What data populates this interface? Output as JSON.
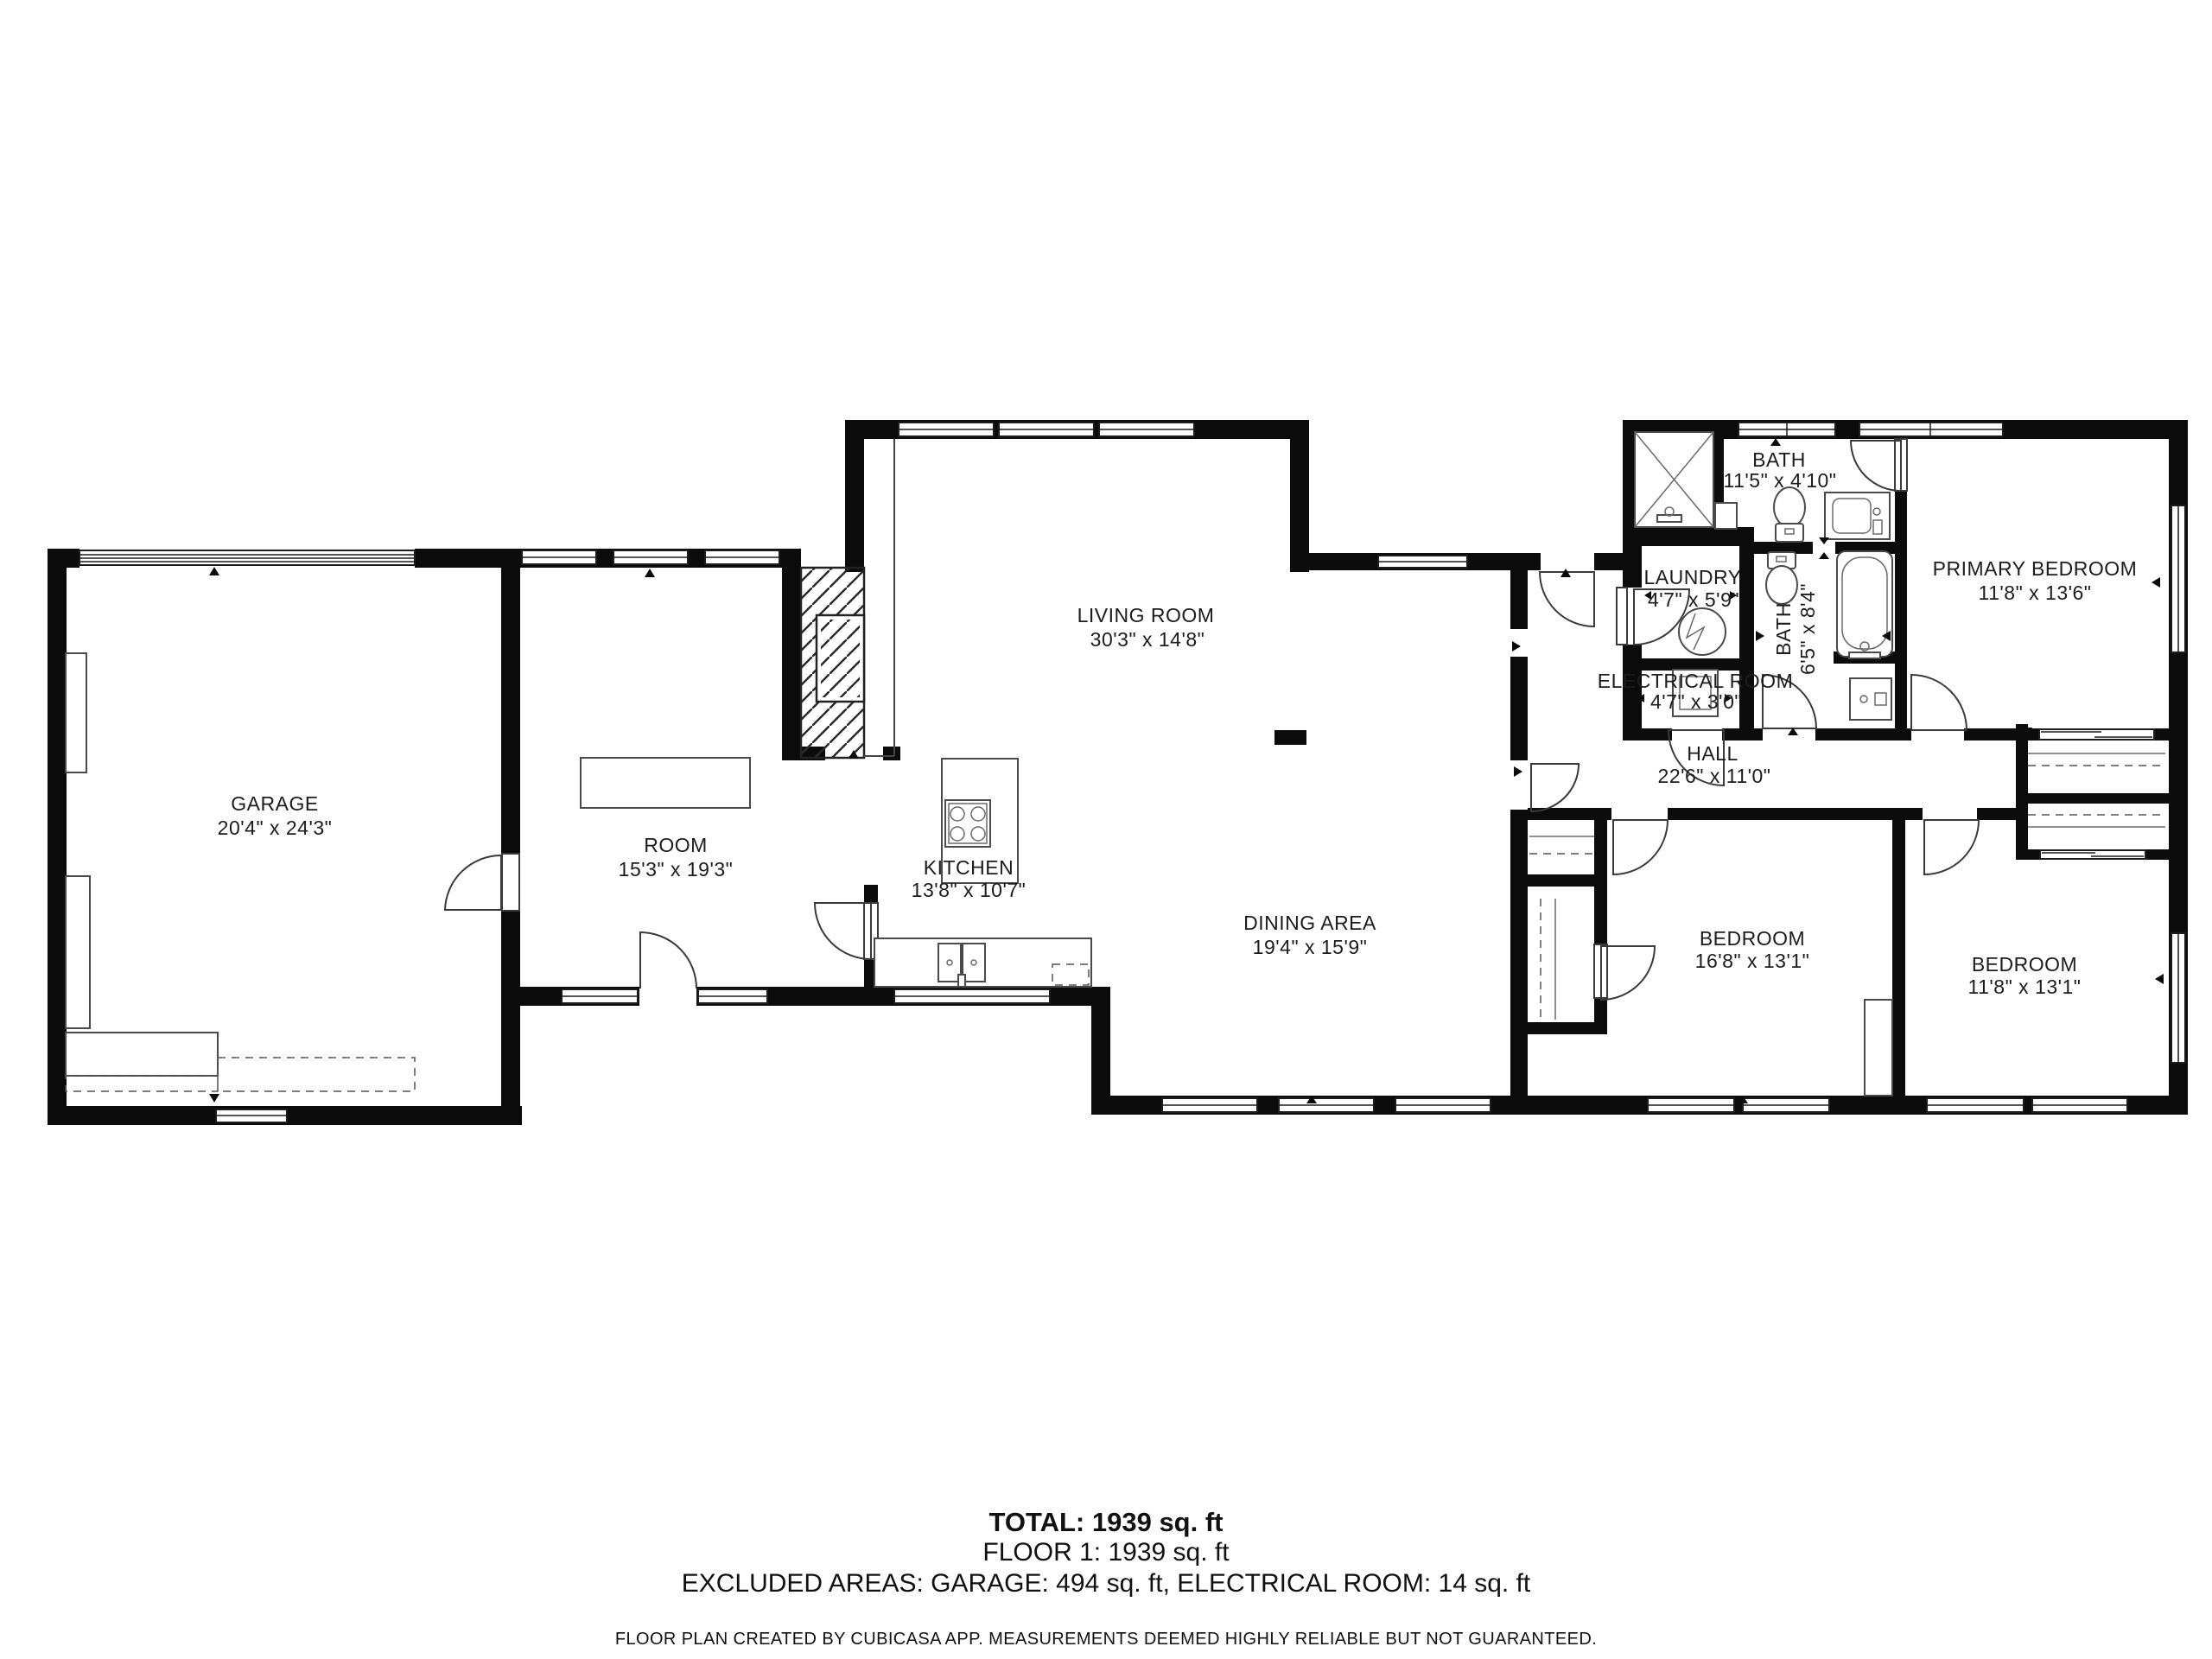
{
  "plan": {
    "rooms": [
      {
        "name": "GARAGE",
        "dims": "20'4\" x 24'3\""
      },
      {
        "name": "ROOM",
        "dims": "15'3\" x 19'3\""
      },
      {
        "name": "KITCHEN",
        "dims": "13'8\" x 10'7\""
      },
      {
        "name": "LIVING ROOM",
        "dims": "30'3\" x 14'8\""
      },
      {
        "name": "DINING AREA",
        "dims": "19'4\" x 15'9\""
      },
      {
        "name": "LAUNDRY",
        "dims": "4'7\" x 5'9\""
      },
      {
        "name": "ELECTRICAL ROOM",
        "dims": "4'7\" x 3'0\""
      },
      {
        "name": "BATH",
        "dims": "11'5\" x 4'10\""
      },
      {
        "name": "BATH",
        "dims": "6'5\" x 8'4\""
      },
      {
        "name": "HALL",
        "dims": "22'6\" x 11'0\""
      },
      {
        "name": "PRIMARY BEDROOM",
        "dims": "11'8\" x 13'6\""
      },
      {
        "name": "BEDROOM",
        "dims": "16'8\" x 13'1\""
      },
      {
        "name": "BEDROOM",
        "dims": "11'8\" x 13'1\""
      }
    ],
    "summary": {
      "total": "TOTAL: 1939 sq. ft",
      "floor1": "FLOOR 1: 1939 sq. ft",
      "excluded": "EXCLUDED AREAS: GARAGE: 494 sq. ft, ELECTRICAL ROOM: 14 sq. ft",
      "disclaimer": "FLOOR PLAN CREATED BY CUBICASA APP. MEASUREMENTS DEEMED HIGHLY RELIABLE BUT NOT GUARANTEED."
    },
    "colors": {
      "walls": "#0b0b0b",
      "background": "#ffffff",
      "fixtures": "#4a4a4a"
    }
  }
}
